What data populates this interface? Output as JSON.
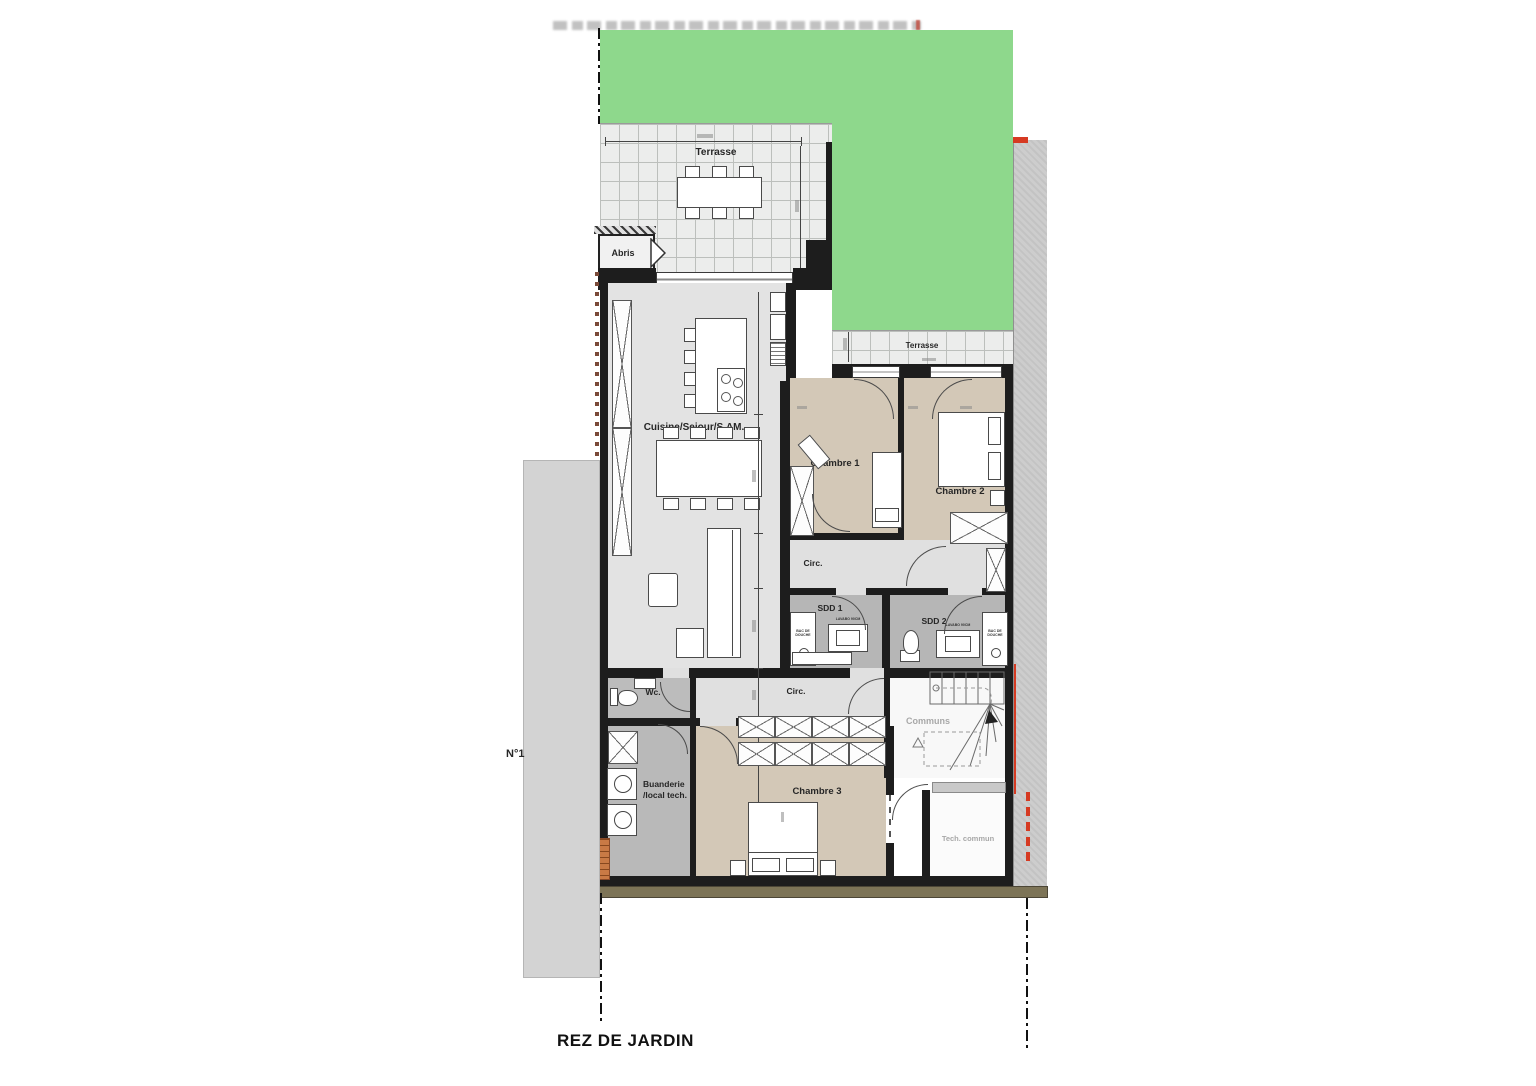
{
  "plan_title": "REZ DE JARDIN",
  "unit_label": "N°1",
  "rooms": {
    "terrasse_main": "Terrasse",
    "abris": "Abris",
    "terrasse_back": "Terrasse",
    "cuisine_sejour": "Cuisine/Sejour/S.AM.",
    "chambre_1": "Chambre 1",
    "chambre_2": "Chambre 2",
    "chambre_3": "Chambre 3",
    "circ_upper": "Circ.",
    "circ_lower": "Circ.",
    "sdd_1": "SDD 1",
    "sdd_2": "SDD 2",
    "wc": "Wc.",
    "buanderie_line1": "Buanderie",
    "buanderie_line2": "/local tech.",
    "communs": "Communs",
    "tech_commun": "Tech. commun"
  },
  "fixture_labels": {
    "sdd1_shower": "BAC DE DOUCHE",
    "sdd1_vanity": "LAVABO 90CM",
    "sdd2_shower": "BAC DE DOUCHE",
    "sdd2_vanity": "LAVABO 90CM"
  },
  "colors": {
    "garden_green": "#8ed88c",
    "bedroom_floor": "#d3c8b7",
    "living_floor": "#e3e3e3",
    "bathroom_floor": "#b6b6b6",
    "service_floor": "#b9b9b9",
    "corridor_floor": "#e0e0e0",
    "wall": "#1d1d1d",
    "foundation_band": "#7d7457",
    "accent_red": "#d63a22",
    "neighbor_strip": "#cdcdcd"
  }
}
